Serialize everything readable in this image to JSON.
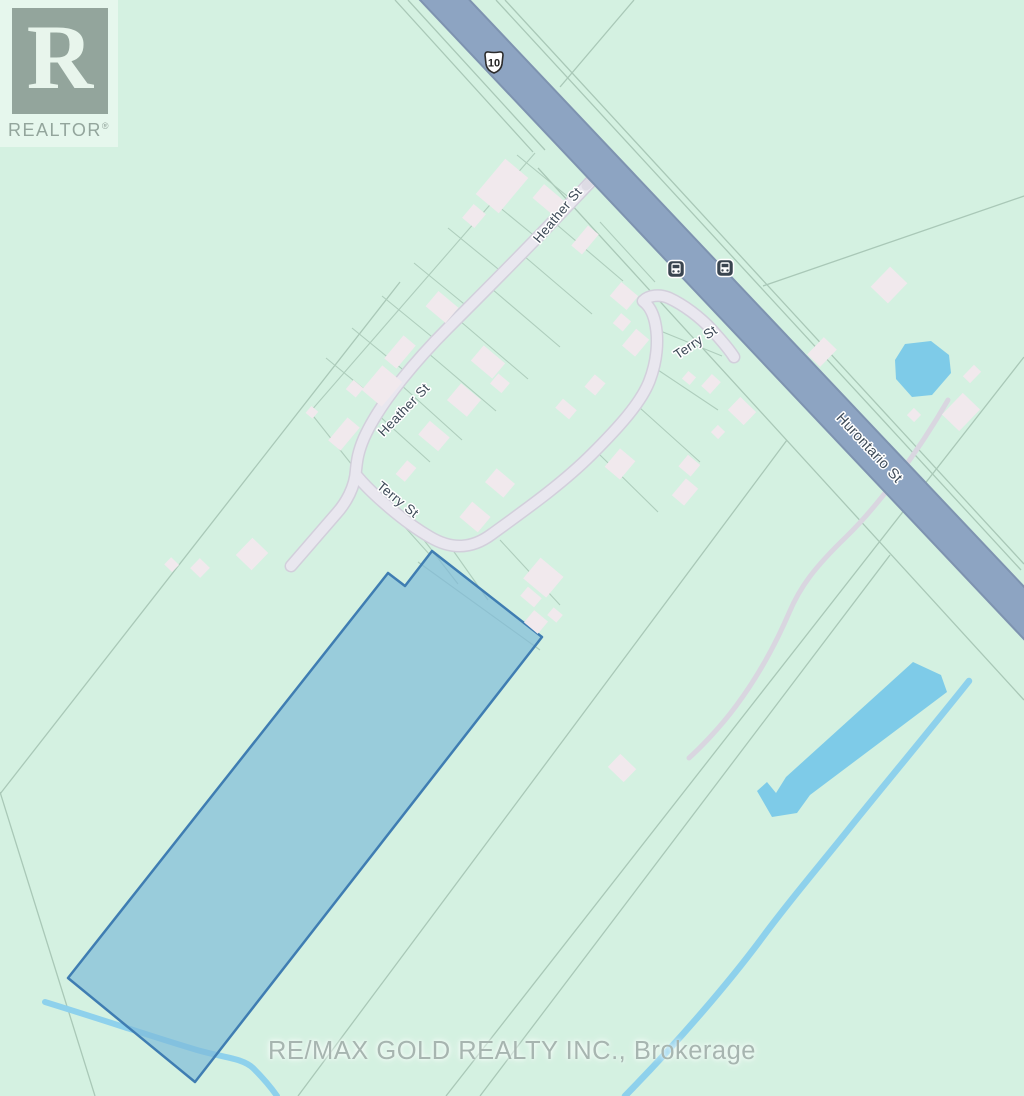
{
  "map": {
    "attribution_logo": {
      "monogram": "R",
      "brand": "REALTOR",
      "registered_mark": "®"
    },
    "watermark_text": "RE/MAX GOLD REALTY INC., Brokerage",
    "highway_shield_label": "10",
    "labels": {
      "heather_st_upper": "Heather St",
      "heather_st_lower": "Heather St",
      "terry_st_upper": "Terry St",
      "terry_st_lower": "Terry St",
      "hurontario_st": "Hurontario St"
    },
    "transit_stops": [
      {
        "icon": "bus"
      },
      {
        "icon": "bus"
      }
    ],
    "features": {
      "highlighted_parcel": "subject property boundary (blue)",
      "water": [
        "pond",
        "long-pond",
        "stream",
        "creek"
      ]
    },
    "colors": {
      "background": "#d4f1e1",
      "highway": "#8da4c2",
      "road": "#e9e7ef",
      "parcel_line": "#a9c8b7",
      "water": "#7ecbe8",
      "highlight_fill": "#7db9d8",
      "highlight_stroke": "#3f7db2",
      "building": "#f1e9ed",
      "label_text": "#3d4a57"
    }
  }
}
